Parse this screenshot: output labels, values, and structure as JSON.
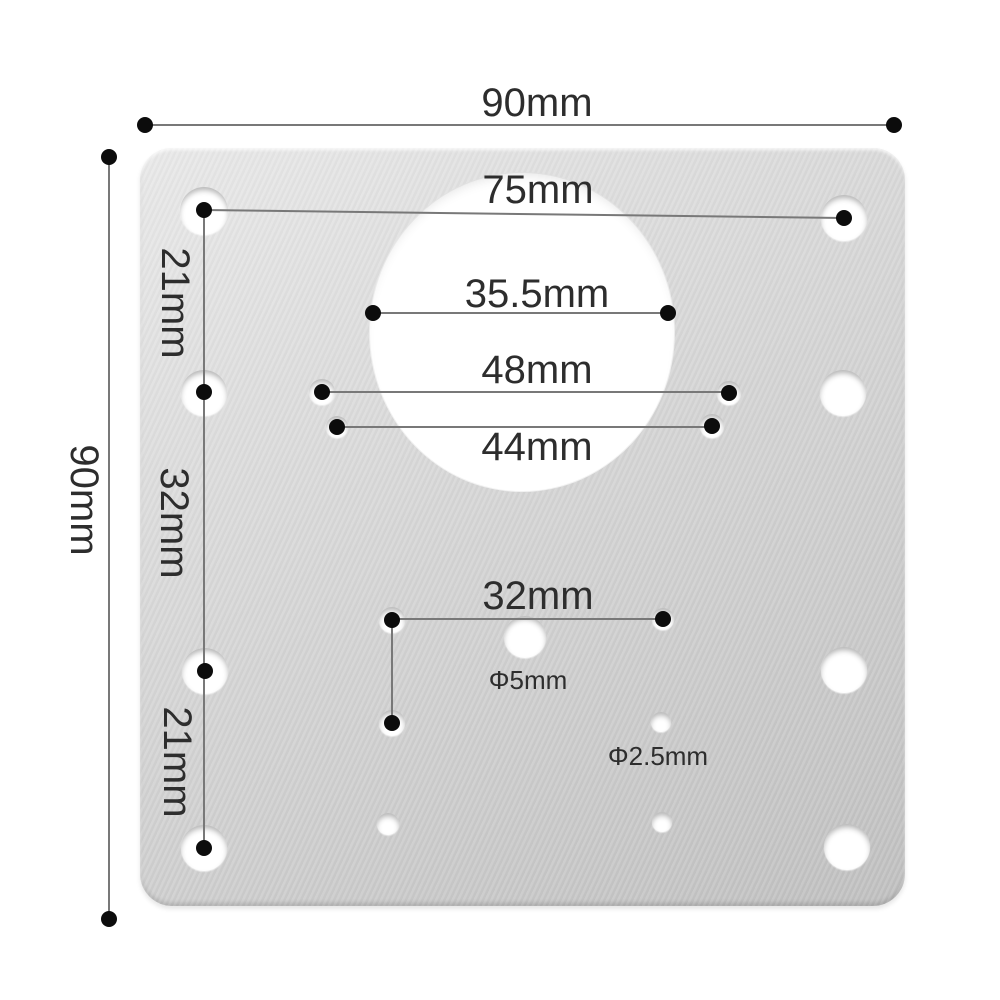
{
  "scene": {
    "type": "product-dimension-diagram",
    "subject": "stainless hinge repair mounting plate, top view with measurements"
  },
  "labels": {
    "overall_width": "90mm",
    "overall_height": "90mm",
    "top_holes_span": "75mm",
    "cup_hole_span": "35.5mm",
    "mid_span_48": "48mm",
    "mid_span_44": "44mm",
    "left_span_top": "21mm",
    "left_span_middle": "32mm",
    "left_span_bottom": "21mm",
    "screw_span_32": "32mm",
    "center_hole_diameter": "Φ5mm",
    "pilot_hole_diameter": "Φ2.5mm"
  },
  "colors": {
    "background": "#ffffff",
    "plate_light": "#e9e9e9",
    "plate_dark": "#c0c0c0",
    "dimension_line": "#787878",
    "endpoint_dot": "#0c0c0c",
    "text": "#2d2d2d"
  }
}
